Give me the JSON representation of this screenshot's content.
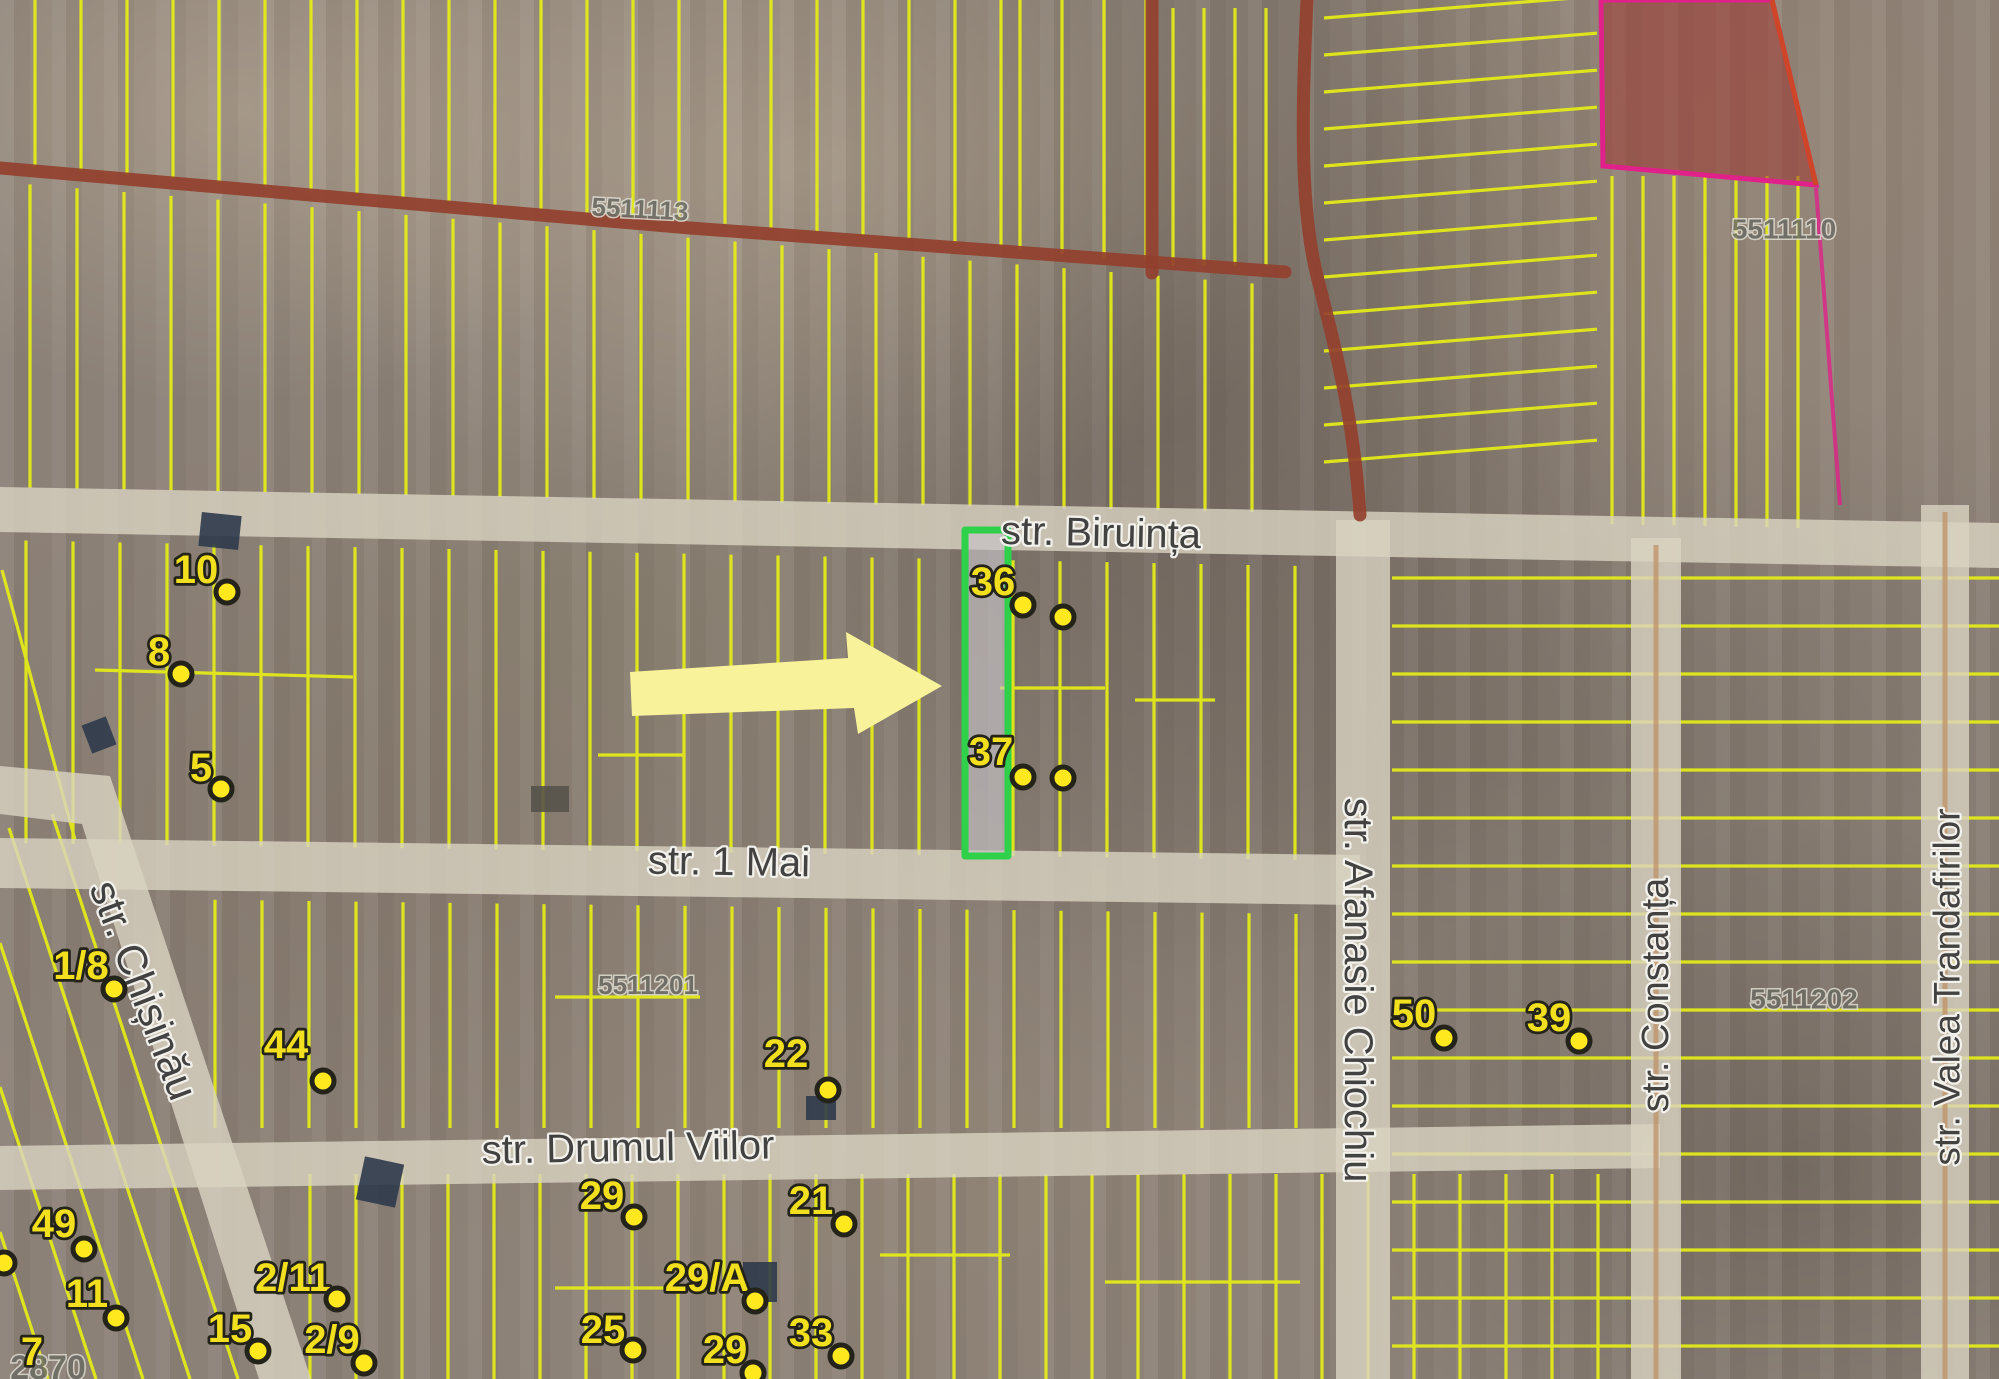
{
  "colors": {
    "parcel_line": "#e6ee16",
    "road_fill": "#d9d3c2",
    "road_center_line": "#bf9166",
    "road_brown": "#93402e",
    "red_zone_fill": "rgba(158,52,44,0.52)",
    "red_zone_border": "#e0218a",
    "red_zone_edge": "#cf4528",
    "highlight_green": "#2fd04a",
    "highlight_fill": "rgba(198,196,200,0.62)",
    "arrow": "#f8f29a",
    "marker_yellow": "#f2df1d",
    "dot_yellow": "#ffe81e",
    "marker_outline": "#23231a",
    "street_text": "#3c3c3c",
    "street_halo": "#f5f4f0",
    "cadastral_text": "#6c6c64",
    "cadastral_halo": "#dedcd2",
    "building_dark": "#2e3a4b",
    "building_light": "#56524a"
  },
  "streets": [
    {
      "id": "biruinta",
      "name": "str. Biruința",
      "x": 1101,
      "y": 533,
      "rotation": 1.2,
      "size": 40
    },
    {
      "id": "1mai",
      "name": "str. 1 Mai",
      "x": 729,
      "y": 862,
      "rotation": 1,
      "size": 40
    },
    {
      "id": "drumul-viilor",
      "name": "str. Drumul Viilor",
      "x": 628,
      "y": 1148,
      "rotation": -1,
      "size": 40
    },
    {
      "id": "chisinau",
      "name": "str. Chișinău",
      "x": 144,
      "y": 990,
      "rotation": 69,
      "size": 42
    },
    {
      "id": "afanasie-chiochiu",
      "name": "str. Afanasie Chiochiu",
      "x": 1358,
      "y": 990,
      "rotation": 90,
      "size": 40
    },
    {
      "id": "constanta",
      "name": "str. Constanța",
      "x": 1656,
      "y": 995,
      "rotation": -90,
      "size": 38
    },
    {
      "id": "valea-trandafirilor",
      "name": "str. Valea Trandafirilor",
      "x": 1947,
      "y": 987,
      "rotation": -90,
      "size": 37
    }
  ],
  "cadastral": [
    {
      "id": "5511113",
      "code": "5511113",
      "x": 640,
      "y": 209,
      "rotation": 3,
      "size": 26
    },
    {
      "id": "5511110",
      "code": "5511110",
      "x": 1784,
      "y": 229,
      "rotation": 0,
      "size": 28
    },
    {
      "id": "5511201",
      "code": "5511201",
      "x": 648,
      "y": 985,
      "rotation": 0,
      "size": 26
    },
    {
      "id": "5511202",
      "code": "5511202",
      "x": 1804,
      "y": 999,
      "rotation": 0,
      "size": 28
    },
    {
      "id": "2870",
      "code": "2870",
      "x": 48,
      "y": 1368,
      "rotation": 0,
      "size": 34
    }
  ],
  "markers": [
    {
      "label": "10",
      "x": 196,
      "y": 570,
      "dots": [
        [
          227,
          592
        ]
      ]
    },
    {
      "label": "8",
      "x": 159,
      "y": 652,
      "dots": [
        [
          181,
          674
        ]
      ]
    },
    {
      "label": "5",
      "x": 201,
      "y": 768,
      "dots": [
        [
          221,
          789
        ]
      ]
    },
    {
      "label": "36",
      "x": 993,
      "y": 582,
      "dots": [
        [
          1023,
          605
        ],
        [
          1063,
          617
        ]
      ]
    },
    {
      "label": "37",
      "x": 991,
      "y": 752,
      "dots": [
        [
          1023,
          777
        ],
        [
          1063,
          778
        ]
      ]
    },
    {
      "label": "1/8",
      "x": 81,
      "y": 966,
      "dots": [
        [
          114,
          989
        ]
      ]
    },
    {
      "label": "44",
      "x": 286,
      "y": 1045,
      "dots": [
        [
          323,
          1081
        ]
      ]
    },
    {
      "label": "22",
      "x": 786,
      "y": 1054,
      "dots": [
        [
          828,
          1090
        ]
      ]
    },
    {
      "label": "50",
      "x": 1414,
      "y": 1014,
      "dots": [
        [
          1444,
          1038
        ]
      ]
    },
    {
      "label": "39",
      "x": 1549,
      "y": 1018,
      "dots": [
        [
          1579,
          1041
        ]
      ]
    },
    {
      "label": "29",
      "x": 602,
      "y": 1196,
      "dots": [
        [
          634,
          1217
        ]
      ]
    },
    {
      "label": "21",
      "x": 811,
      "y": 1201,
      "dots": [
        [
          844,
          1224
        ]
      ]
    },
    {
      "label": "29/A",
      "x": 707,
      "y": 1278,
      "dots": [
        [
          755,
          1301
        ]
      ]
    },
    {
      "label": "25",
      "x": 603,
      "y": 1330,
      "dots": [
        [
          633,
          1350
        ]
      ]
    },
    {
      "label": "29",
      "x": 725,
      "y": 1350,
      "dots": [
        [
          753,
          1373
        ]
      ]
    },
    {
      "label": "33",
      "x": 811,
      "y": 1333,
      "dots": [
        [
          841,
          1356
        ]
      ]
    },
    {
      "label": "49",
      "x": 54,
      "y": 1224,
      "dots": [
        [
          84,
          1249
        ]
      ]
    },
    {
      "label": "11",
      "x": 87,
      "y": 1294,
      "dots": [
        [
          116,
          1318
        ]
      ]
    },
    {
      "label": "2/11",
      "x": 293,
      "y": 1278,
      "dots": [
        [
          337,
          1299
        ]
      ]
    },
    {
      "label": "15",
      "x": 230,
      "y": 1329,
      "dots": [
        [
          258,
          1351
        ]
      ]
    },
    {
      "label": "2/9",
      "x": 332,
      "y": 1340,
      "dots": [
        [
          364,
          1363
        ]
      ]
    },
    {
      "label": "7",
      "x": 32,
      "y": 1352,
      "dots": []
    },
    {
      "label": "",
      "x": -60,
      "y": -60,
      "dots": [
        [
          4,
          1263
        ]
      ]
    }
  ],
  "highlight_parcel": {
    "x": 965,
    "y": 530,
    "w": 43,
    "h": 326
  },
  "arrow": {
    "points": "630,672 848,658 846,632 942,686 858,734 854,708 632,716"
  },
  "roads_light": [
    {
      "id": "road-biruinta",
      "points": "0,487 1999,523 1999,568 0,532"
    },
    {
      "id": "road-1mai",
      "points": "0,838 1360,855 1360,905 0,888"
    },
    {
      "id": "road-drumul-viilor",
      "points": "0,1146 1660,1124 1660,1168 0,1190"
    },
    {
      "id": "road-chisinau",
      "points": "0,766 110,776 311,1379 259,1379 82,824 0,814"
    },
    {
      "id": "road-chiochiu",
      "points": "1336,520 1390,520 1390,1379 1336,1379"
    },
    {
      "id": "road-constanta",
      "points": "1631,538 1681,538 1681,1379 1631,1379"
    },
    {
      "id": "road-valea",
      "points": "1921,505 1969,505 1969,1379 1921,1379"
    }
  ],
  "road_center_lines": [
    {
      "x1": 1656,
      "y1": 545,
      "x2": 1656,
      "y2": 1379
    },
    {
      "x1": 1945,
      "y1": 512,
      "x2": 1945,
      "y2": 1379
    }
  ],
  "roads_brown": [
    {
      "id": "brown-road-west",
      "d": "M0,168 L690,228 L1285,272"
    },
    {
      "id": "brown-road-north",
      "d": "M1307,0 C1303,90 1298,200 1317,276 C1336,350 1354,420 1360,515"
    },
    {
      "id": "brown-boundary",
      "d": "M1152,0 L1152,273"
    }
  ],
  "red_zone": {
    "points": "1601,0 1772,0 1816,185 1603,166",
    "edge_d": "M1772,0 L1816,185",
    "tail_d": "M1816,188 L1840,505"
  },
  "parcels": {
    "v_groups": [
      {
        "x0": 35,
        "x1": 1005,
        "step": 46,
        "top": [
          0,
          0
        ],
        "bot": [
          165,
          0.081
        ]
      },
      {
        "x0": 1020,
        "x1": 1148,
        "step": 42,
        "top": [
          0,
          0
        ],
        "bot": [
          168,
          0.081
        ]
      },
      {
        "x0": 30,
        "x1": 1290,
        "step": 47,
        "top": [
          182,
          0.081
        ],
        "bot": [
          487,
          0.02
        ]
      },
      {
        "x0": 26,
        "x1": 1325,
        "step": 47,
        "top": [
          540,
          0.02
        ],
        "bot": [
          843,
          0.013
        ]
      },
      {
        "x0": 215,
        "x1": 1330,
        "step": 47,
        "top": [
          897,
          0.013
        ],
        "bot": [
          1128,
          0
        ]
      },
      {
        "x0": 310,
        "x1": 1620,
        "step": 46,
        "top": [
          1174,
          0
        ],
        "bot": [
          1379,
          0
        ]
      },
      {
        "x0": 1612,
        "x1": 1800,
        "step": 31,
        "top": [
          176,
          0
        ],
        "bot": [
          492,
          0.02
        ]
      },
      {
        "x0": 1173,
        "x1": 1270,
        "step": 31,
        "top": [
          8,
          0
        ],
        "bot": [
          266,
          0
        ]
      }
    ],
    "h_groups": [
      {
        "y0": 578,
        "y1": 1368,
        "step": 48,
        "xL": 1392,
        "xR": 1999,
        "slope": 0
      },
      {
        "y0": 18,
        "y1": 470,
        "step": 37,
        "xL": 1324,
        "xR": 1597,
        "slope": -0.08
      }
    ],
    "segments": [
      [
        95,
        670,
        353,
        677
      ],
      [
        1000,
        688,
        1105,
        688
      ],
      [
        1135,
        700,
        1215,
        700
      ],
      [
        555,
        997,
        700,
        997
      ],
      [
        598,
        755,
        685,
        755
      ],
      [
        555,
        1288,
        665,
        1288
      ],
      [
        880,
        1255,
        1010,
        1255
      ],
      [
        1105,
        1282,
        1300,
        1282
      ],
      [
        2,
        570,
        75,
        840
      ],
      [
        52,
        814,
        238,
        1379
      ],
      [
        9,
        828,
        190,
        1379
      ],
      [
        0,
        943,
        143,
        1379
      ],
      [
        0,
        1087,
        96,
        1379
      ],
      [
        0,
        1232,
        48,
        1379
      ]
    ]
  },
  "buildings": [
    {
      "x": 200,
      "y": 514,
      "w": 40,
      "h": 34,
      "rot": 6,
      "tone": "dark"
    },
    {
      "x": 84,
      "y": 722,
      "w": 30,
      "h": 26,
      "rot": 69,
      "tone": "dark"
    },
    {
      "x": 531,
      "y": 786,
      "w": 38,
      "h": 26,
      "rot": 0,
      "tone": "light"
    },
    {
      "x": 743,
      "y": 1262,
      "w": 34,
      "h": 40,
      "rot": 0,
      "tone": "dark"
    },
    {
      "x": 806,
      "y": 1096,
      "w": 30,
      "h": 24,
      "rot": 0,
      "tone": "dark"
    },
    {
      "x": 360,
      "y": 1160,
      "w": 40,
      "h": 44,
      "rot": 12,
      "tone": "dark"
    }
  ]
}
